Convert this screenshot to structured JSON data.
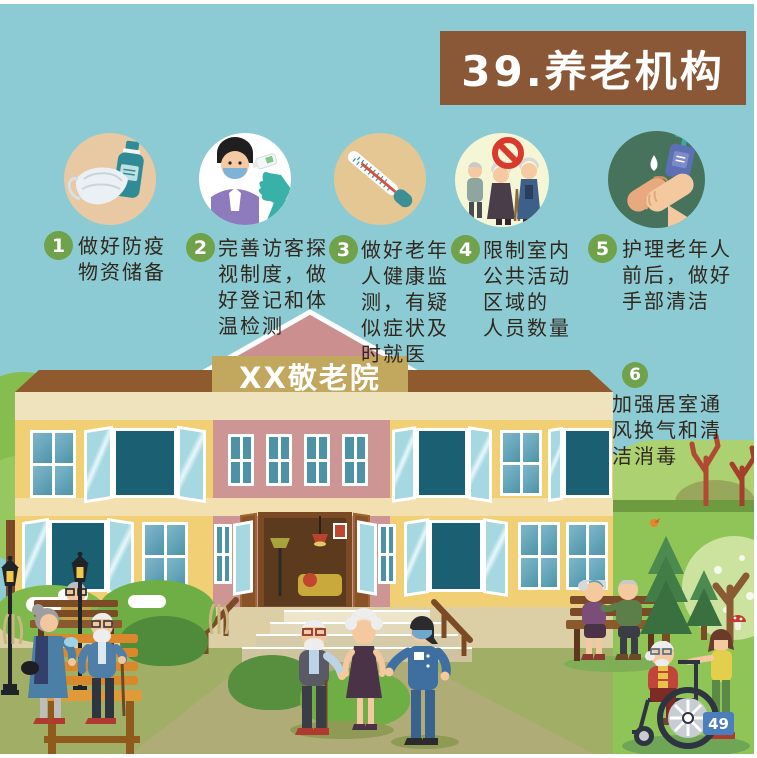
{
  "header": {
    "title": "39.养老机构"
  },
  "building": {
    "sign": "XX敬老院"
  },
  "page": {
    "number": "49"
  },
  "steps": [
    {
      "num": "1",
      "icon": "mask-and-sanitizer-icon",
      "text": "做好防疫\n物资储备"
    },
    {
      "num": "2",
      "icon": "temperature-check-icon",
      "text": "完善访客探\n视制度，做\n好登记和体\n温检测"
    },
    {
      "num": "3",
      "icon": "thermometer-icon",
      "text": "做好老年\n人健康监\n测，有疑\n似症状及\n时就医"
    },
    {
      "num": "4",
      "icon": "no-crowd-icon",
      "text": "限制室内\n公共活动\n区域的\n人员数量"
    },
    {
      "num": "5",
      "icon": "hand-washing-icon",
      "text": "护理老年人\n前后，做好\n手部清洁"
    },
    {
      "num": "6",
      "icon": "ventilation",
      "text": "加强居室通\n风换气和清\n洁消毒"
    }
  ],
  "colors": {
    "sky": "#8CCBD4",
    "banner_brown": "#8A5836",
    "step_number_green": "#6FA24B",
    "text_dark": "#30271D",
    "building_yellow": "#F1CF74",
    "building_pink": "#CE9595",
    "roof_brown": "#8F5B2E",
    "sign_tan": "#C2A75F",
    "window_teal": "#1B5F72",
    "lawn_olive": "#A0AE66",
    "grass_green": "#8FC457",
    "badge_blue": "#4B7EBD"
  }
}
